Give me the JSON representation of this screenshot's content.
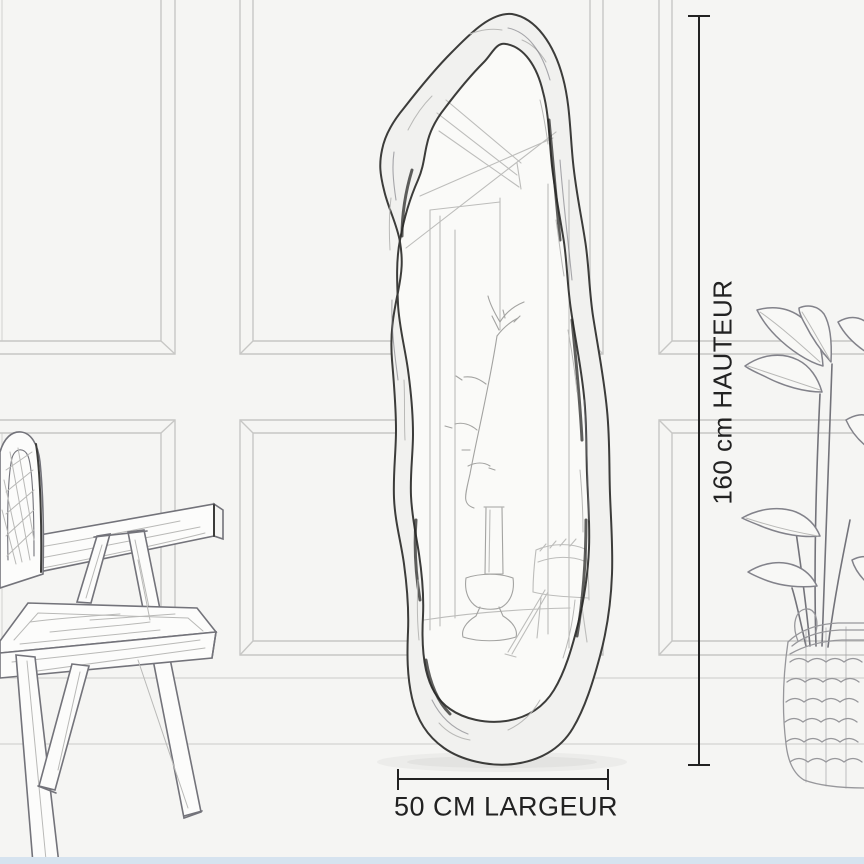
{
  "illustration": {
    "type": "product-dimension-sketch",
    "items": [
      "organic-shaped-mirror",
      "wall-paneling",
      "wooden-chair",
      "leafy-plant",
      "woven-basket"
    ]
  },
  "dimensions": {
    "height_label": "160 cm HAUTEUR",
    "width_label": "50 CM LARGEUR"
  },
  "colors": {
    "background": "#f5f5f3",
    "annotation": "#222222",
    "panel-line": "#c7c7c5",
    "sketch-dark": "#3c3c3a",
    "sketch-mid": "#73737a",
    "sketch-light": "#b9b9b7",
    "accent-strip": "#d6e3ef"
  }
}
